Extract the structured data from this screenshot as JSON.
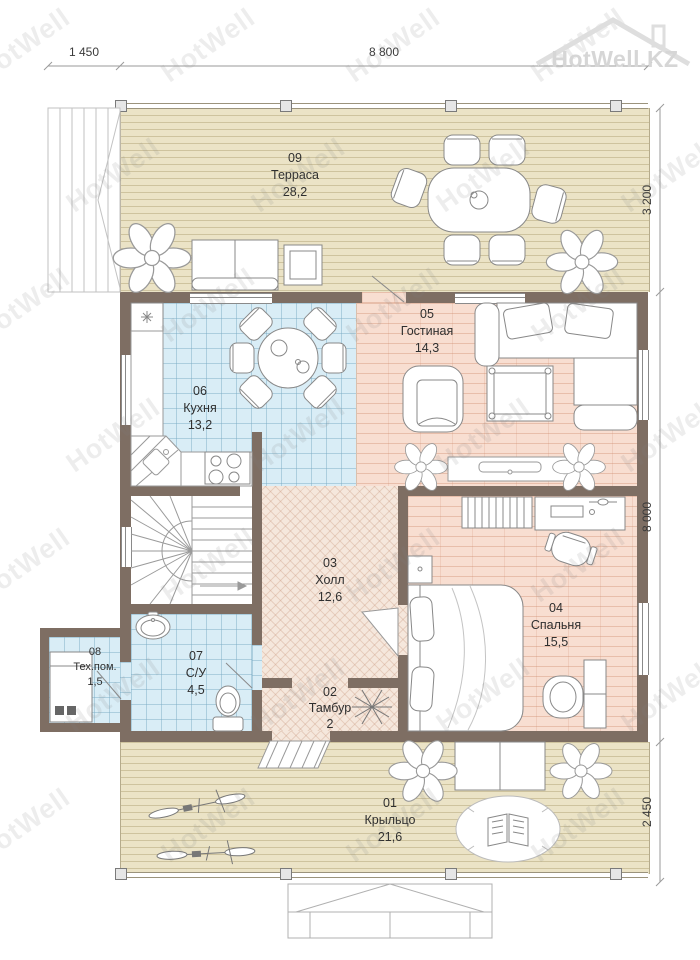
{
  "logo": {
    "text": "HotWell.KZ"
  },
  "watermark": {
    "text": "HotWell"
  },
  "dimensions": {
    "top": [
      {
        "label": "1 450"
      },
      {
        "label": "8 800"
      }
    ],
    "right": [
      {
        "label": "3 200"
      },
      {
        "label": "8 000"
      },
      {
        "label": "2 450"
      }
    ]
  },
  "rooms": [
    {
      "number": "09",
      "name": "Терраса",
      "area": "28,2"
    },
    {
      "number": "05",
      "name": "Гостиная",
      "area": "14,3"
    },
    {
      "number": "06",
      "name": "Кухня",
      "area": "13,2"
    },
    {
      "number": "03",
      "name": "Холл",
      "area": "12,6"
    },
    {
      "number": "04",
      "name": "Спальня",
      "area": "15,5"
    },
    {
      "number": "02",
      "name": "Тамбур",
      "area": "2"
    },
    {
      "number": "07",
      "name": "С/У",
      "area": "4,5"
    },
    {
      "number": "08",
      "name": "Тех.пом.",
      "area": "1,5"
    },
    {
      "number": "01",
      "name": "Крыльцо",
      "area": "21,6"
    }
  ],
  "colors": {
    "wall": "#7e6e63",
    "plank": "#ebe3c6",
    "tile": "#d9edf6",
    "brick": "#f8ded1",
    "herr": "#f5e7dc"
  }
}
